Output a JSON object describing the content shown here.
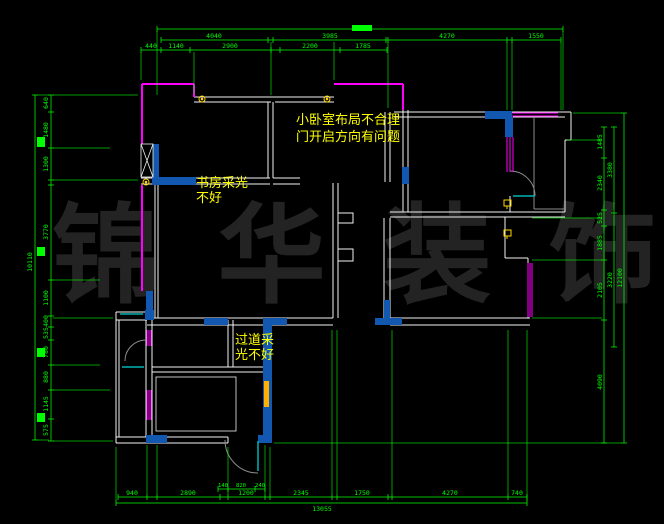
{
  "meta": {
    "description": "CAD floor-plan drawing on black canvas with green dimension chains, colored wall layers and yellow review notes"
  },
  "colors": {
    "background": "#000000",
    "dimension_green": "#00ff00",
    "wall_white": "#f2f2f2",
    "window_blue": "#1258b0",
    "outer_magenta": "#ff00ff",
    "sill_cyan": "#00b2b2",
    "symbol_yellow": "#ffd700",
    "note_yellow": "#ffff00",
    "door_gray": "#8c8c8c",
    "watermark_gray": "#232323",
    "accent_orange": "#ffb000"
  },
  "watermark": {
    "text": "锦 华 装 饰"
  },
  "notes": {
    "small_bedroom": {
      "line1": "小卧室布局不合理",
      "line2": "门开启方向有问题"
    },
    "study": {
      "line1": "书房采光",
      "line2": "不好"
    },
    "corridor": {
      "line1": "过道采",
      "line2": "光不好"
    }
  },
  "dims": {
    "top": {
      "row1": [
        "4040",
        "3985",
        "4270",
        "1550"
      ],
      "row2": [
        "440",
        "1140",
        "2900",
        "2200",
        "1785"
      ]
    },
    "left": {
      "total": "10110",
      "inner": [
        "640",
        "1480",
        "1300",
        "3770",
        "1100",
        "400",
        "535",
        "780",
        "880",
        "1145",
        "575"
      ]
    },
    "right": {
      "inner": [
        "1485",
        "2340",
        "525",
        "1885",
        "2105",
        "4090"
      ],
      "mid": [
        "3380",
        "3220"
      ],
      "total": "12100"
    },
    "bottom": {
      "main": [
        "940",
        "2890",
        "1200",
        "2345",
        "1750",
        "4270",
        "740"
      ],
      "small": [
        "140",
        "820",
        "240"
      ],
      "total": "13055"
    }
  }
}
